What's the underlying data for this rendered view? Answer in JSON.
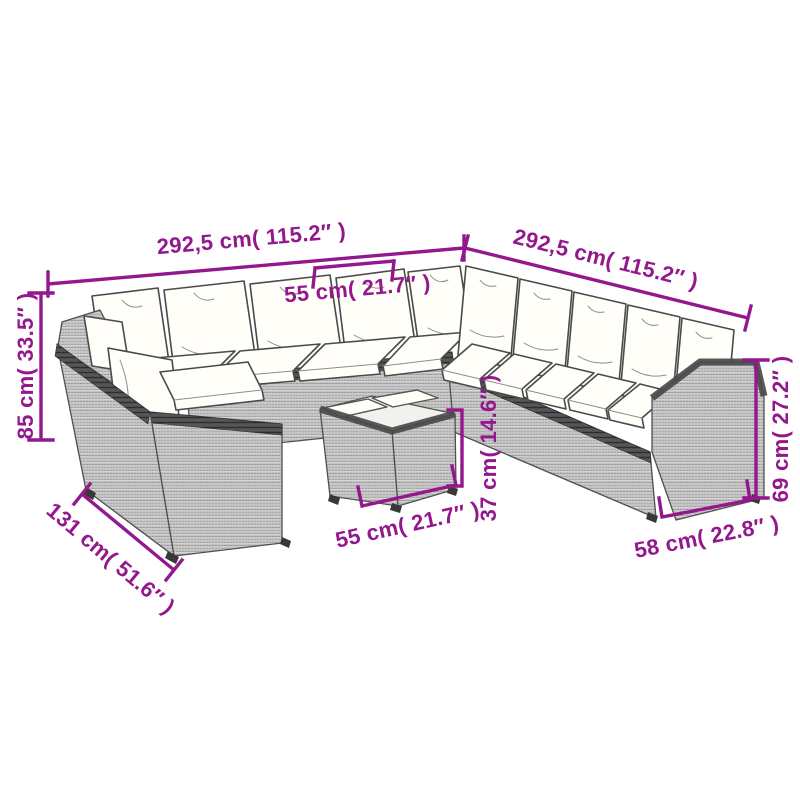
{
  "style": {
    "accent": "#93188D",
    "outline": "#4a4a4a",
    "page_bg": "#ffffff",
    "weave_bg": "#ececec",
    "weave_line": "#9a9a9a",
    "weave_cross": "#c9c9c9",
    "rim_bg": "#565656",
    "rim_line": "#2e2e2e",
    "cushion": "#fffef9",
    "tabletop": "#f1f1ee"
  },
  "product": {
    "alt": "Line drawing of a modular poly rattan corner lounge set with white cushions and a small coffee table with two trays, annotated with dimensions"
  },
  "dimensions": {
    "total_width_left": "292,5 cm( 115.2″ )",
    "total_width_right": "292,5 cm( 115.2″ )",
    "backrest_section_width": "55 cm( 21.7″ )",
    "backrest_height": "85 cm( 33.5″ )",
    "corner_section_depth": "131 cm( 51.6″ )",
    "table_width": "55 cm( 21.7″ )",
    "table_height": "37 cm( 14.6″ )",
    "armrest_height": "69 cm( 27.2″ )",
    "armrest_depth": "58 cm( 22.8″ )"
  }
}
